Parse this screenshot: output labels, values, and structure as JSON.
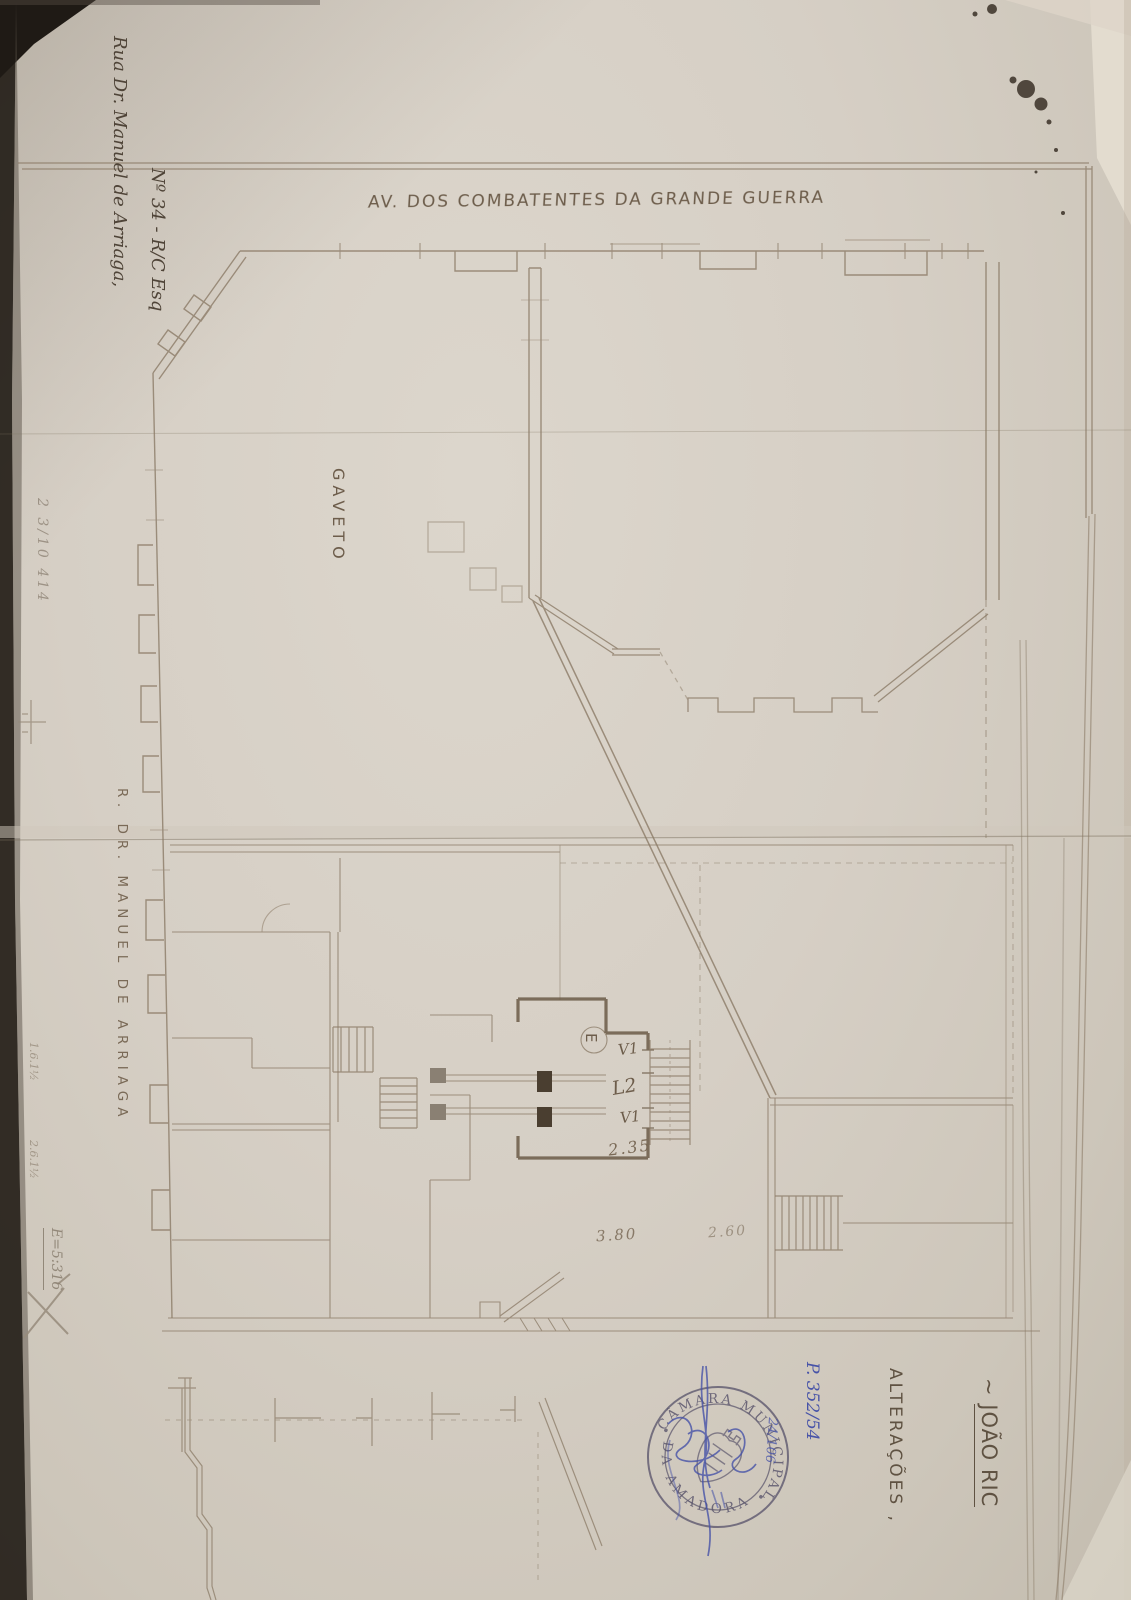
{
  "scan": {
    "streets": {
      "avenue_top": "AV. DOS COMBATENTES DA GRANDE GUERRA",
      "street_left": "R. DR. MANUEL DE ARRIAGA",
      "corner": "GAVETO"
    },
    "handwriting": {
      "address_line1": "Rua Dr. Manuel de Arriaga,",
      "address_line2": "Nº 34 - R/C Esq",
      "owner_prefix": "~",
      "owner_name": "JOÃO RIC",
      "alteracoes": "ALTERAÇÕES ,",
      "process_number": "P. 352/54",
      "blue_note": "24/106",
      "pencil_note": "2 3/10 414",
      "pencil_small_1": "1.6.1½",
      "pencil_small_2": "2.6.1½",
      "pencil_scale": "E=5:316"
    },
    "plan_dimensions": {
      "hall_width": "2.35",
      "span_left": "3.80",
      "span_right": "2.60",
      "opening_top": "V1",
      "opening_mid": "L2",
      "opening_bottom": "V1",
      "room_letter": "E"
    },
    "stamp": {
      "arc_top": "CÂMARA MUNICIPAL",
      "arc_bottom": "DA AMADORA"
    },
    "colors": {
      "paper": "#d5cec4",
      "ink_sepia": "#6d5d4b",
      "line_sepia": "#8b7b67",
      "pencil": "#978b7b",
      "stamp": "#5d586e",
      "ink_blue": "#4753a8"
    }
  }
}
